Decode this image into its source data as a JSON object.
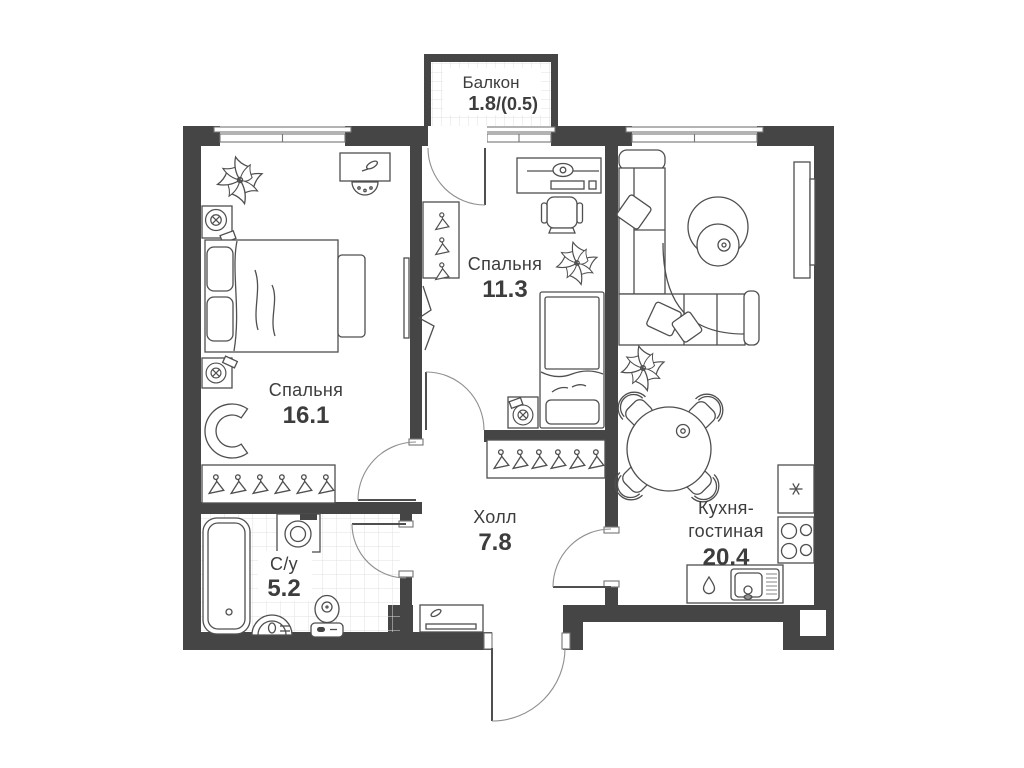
{
  "floor_plan": {
    "rooms": {
      "balcony": {
        "name": "Балкон",
        "area": "1.8",
        "coeff": "/(0.5)"
      },
      "bedroom_large": {
        "name": "Спальня",
        "area": "16.1"
      },
      "bedroom_small": {
        "name": "Спальня",
        "area": "11.3"
      },
      "hall": {
        "name": "Холл",
        "area": "7.8"
      },
      "bathroom": {
        "name": "С/у",
        "area": "5.2"
      },
      "kitchen_living": {
        "name_line1": "Кухня-",
        "name_line2": "гостиная",
        "area": "20.4"
      }
    },
    "icons": {
      "fridge": "snowflake-icon",
      "kitchen_sink": "water-drop-icon",
      "wardrobes": "hanger-icon",
      "plants": "plant-icon"
    },
    "colors": {
      "wall": "#454545",
      "line": "#4f4f4f",
      "line_light": "#8f8f8f",
      "tile": "#e0e0e0",
      "text": "#3d3d3d",
      "background": "#ffffff"
    }
  }
}
